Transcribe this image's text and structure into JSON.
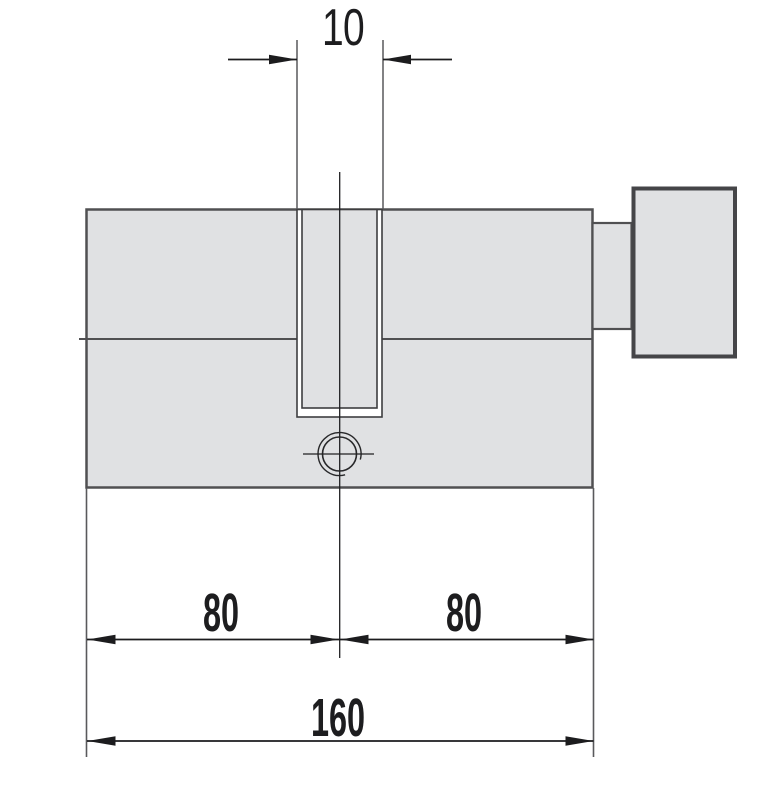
{
  "drawing": {
    "type": "technical-dimension-drawing",
    "subject": "profile cylinder lock with thumb turn",
    "dimensions": {
      "slot_width": "10",
      "left_half": "80",
      "right_half": "80",
      "total_length": "160"
    },
    "colors": {
      "background": "#ffffff",
      "body_fill": "#e0e1e3",
      "body_outline": "#505052",
      "knob_outline": "#454548",
      "slot_outline": "#3e3e40",
      "extension_line": "#59595c",
      "dimension_line": "#1c1c1e",
      "label_text": "#1d1d1f"
    }
  }
}
